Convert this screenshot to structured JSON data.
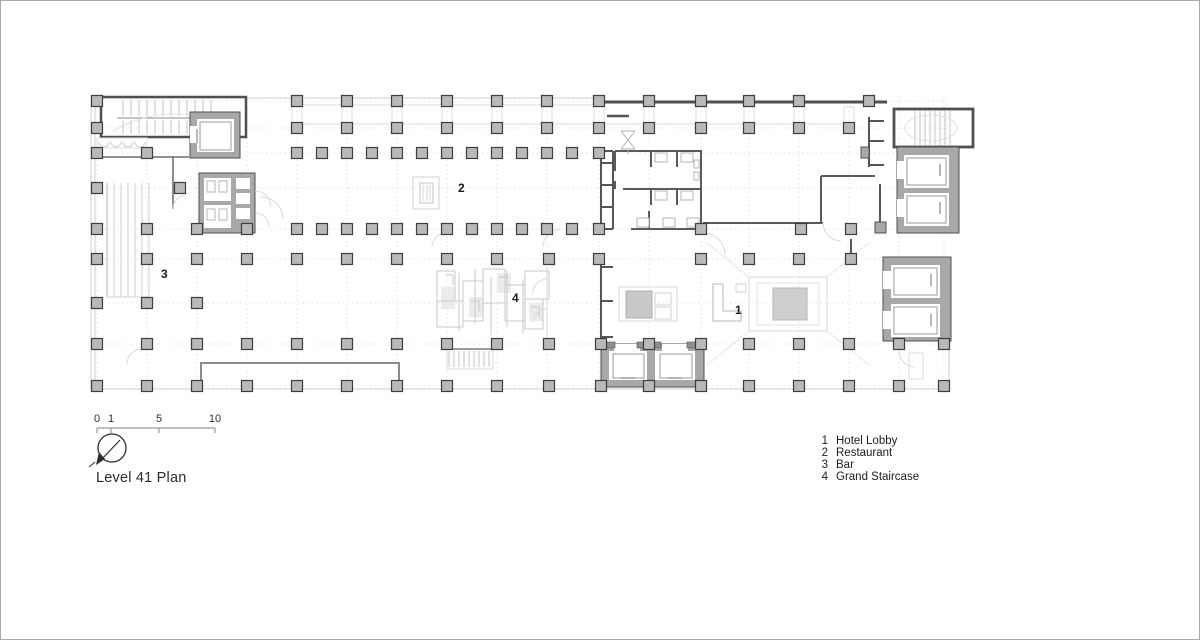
{
  "sheet": {
    "background": "#ffffff",
    "title": "Level 41 Plan"
  },
  "scale_bar": {
    "labels": [
      "0",
      "1",
      "5",
      "10"
    ]
  },
  "north_arrow": {
    "icon": "north-arrow-compass"
  },
  "legend": {
    "items": [
      {
        "num": "1",
        "label": "Hotel Lobby"
      },
      {
        "num": "2",
        "label": "Restaurant"
      },
      {
        "num": "3",
        "label": "Bar"
      },
      {
        "num": "4",
        "label": "Grand Staircase"
      }
    ]
  },
  "room_labels": [
    {
      "num": "1"
    },
    {
      "num": "2"
    },
    {
      "num": "3"
    },
    {
      "num": "4"
    }
  ],
  "plan": {
    "colors": {
      "line_light": "#d9d9d9",
      "line_xlight": "#e6e6e6",
      "line_mid": "#9a9a9a",
      "tread": "#bdbdbd",
      "wall_dark": "#4f4f4f",
      "poche": "#a8a8a8",
      "column_fill": "#b9b9b9",
      "column_stroke": "#3d3d3d"
    },
    "grid": {
      "x": [
        96,
        146,
        196,
        246,
        296,
        346,
        396,
        446,
        496,
        546,
        598,
        648,
        700,
        748,
        798,
        848,
        898,
        943
      ],
      "y": [
        100,
        127,
        152,
        187,
        228,
        258,
        302,
        343,
        385
      ],
      "x_extent": [
        90,
        948
      ],
      "y_extent": [
        96,
        388
      ]
    },
    "column_size": 11,
    "column_rows": [
      {
        "y": 100,
        "xs": [
          96,
          296,
          346,
          396,
          446,
          496,
          546,
          598,
          648,
          700,
          748,
          798,
          868
        ]
      },
      {
        "y": 127,
        "xs": [
          96,
          296,
          346,
          396,
          446,
          496,
          546,
          598,
          648,
          700,
          748,
          798,
          848
        ]
      },
      {
        "y": 152,
        "xs": [
          96,
          146,
          296,
          321,
          346,
          371,
          396,
          421,
          446,
          471,
          496,
          521,
          546,
          571,
          598
        ]
      },
      {
        "y": 187,
        "xs": [
          96,
          179
        ]
      },
      {
        "y": 228,
        "xs": [
          96,
          146,
          196,
          246,
          296,
          321,
          346,
          371,
          396,
          421,
          446,
          471,
          496,
          521,
          546,
          571,
          598,
          700,
          800,
          850
        ]
      },
      {
        "y": 258,
        "xs": [
          96,
          146,
          196,
          246,
          296,
          346,
          396,
          446,
          496,
          548,
          598,
          700,
          748,
          798,
          850
        ]
      },
      {
        "y": 302,
        "xs": [
          96,
          146,
          196
        ]
      },
      {
        "y": 343,
        "xs": [
          96,
          146,
          196,
          246,
          296,
          346,
          396,
          446,
          496,
          548,
          600,
          648,
          700,
          748,
          798,
          848,
          898,
          943
        ]
      },
      {
        "y": 385,
        "xs": [
          96,
          146,
          196,
          246,
          296,
          346,
          396,
          446,
          496,
          548,
          600,
          648,
          700,
          748,
          798,
          848,
          898,
          943
        ]
      }
    ]
  }
}
